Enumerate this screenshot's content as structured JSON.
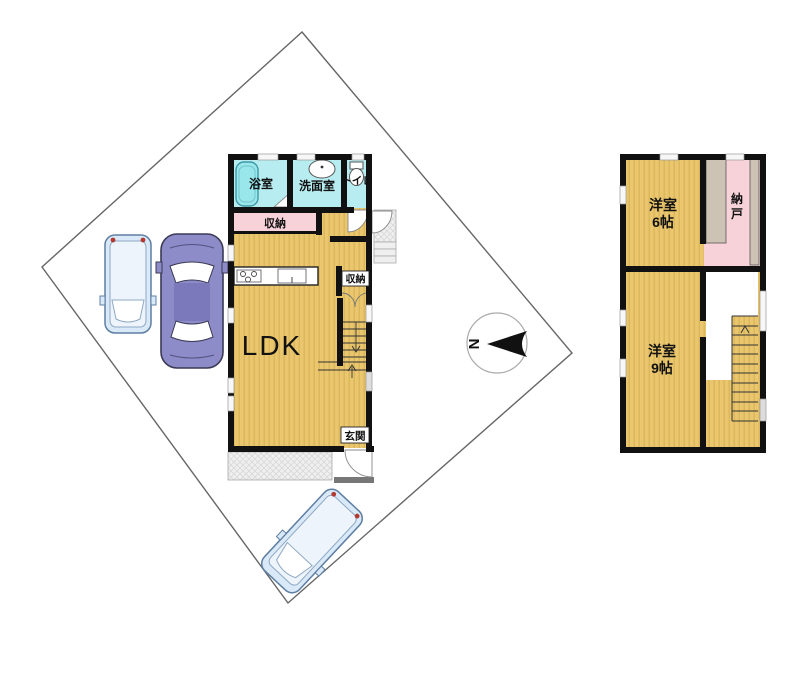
{
  "floor1": {
    "bath_label": "浴室",
    "washroom_label": "洗面室",
    "toilet_label": "トイレ",
    "closet_top_label": "収納",
    "ldk_label": "LDK",
    "closet_mid_label": "収納",
    "entrance_label": "玄関"
  },
  "floor2": {
    "room6_name": "洋室",
    "room6_size": "6帖",
    "storage_char_top": "納",
    "storage_char_bottom": "戸",
    "room9_name": "洋室",
    "room9_size": "9帖"
  },
  "compass": {
    "north": "N"
  },
  "colors": {
    "floor_wood": "#EAC76F",
    "floor_wood_stripe": "#DDB75C",
    "wet_room": "#B7EDF1",
    "tub": "#99E6EB",
    "closet_pink": "#F8D2D9",
    "shelf_gray": "#CDC3B5",
    "wall": "#111111",
    "boundary": "#666666",
    "car_blue": "#D9E9F7",
    "car_purple": "#8D8BC8"
  }
}
